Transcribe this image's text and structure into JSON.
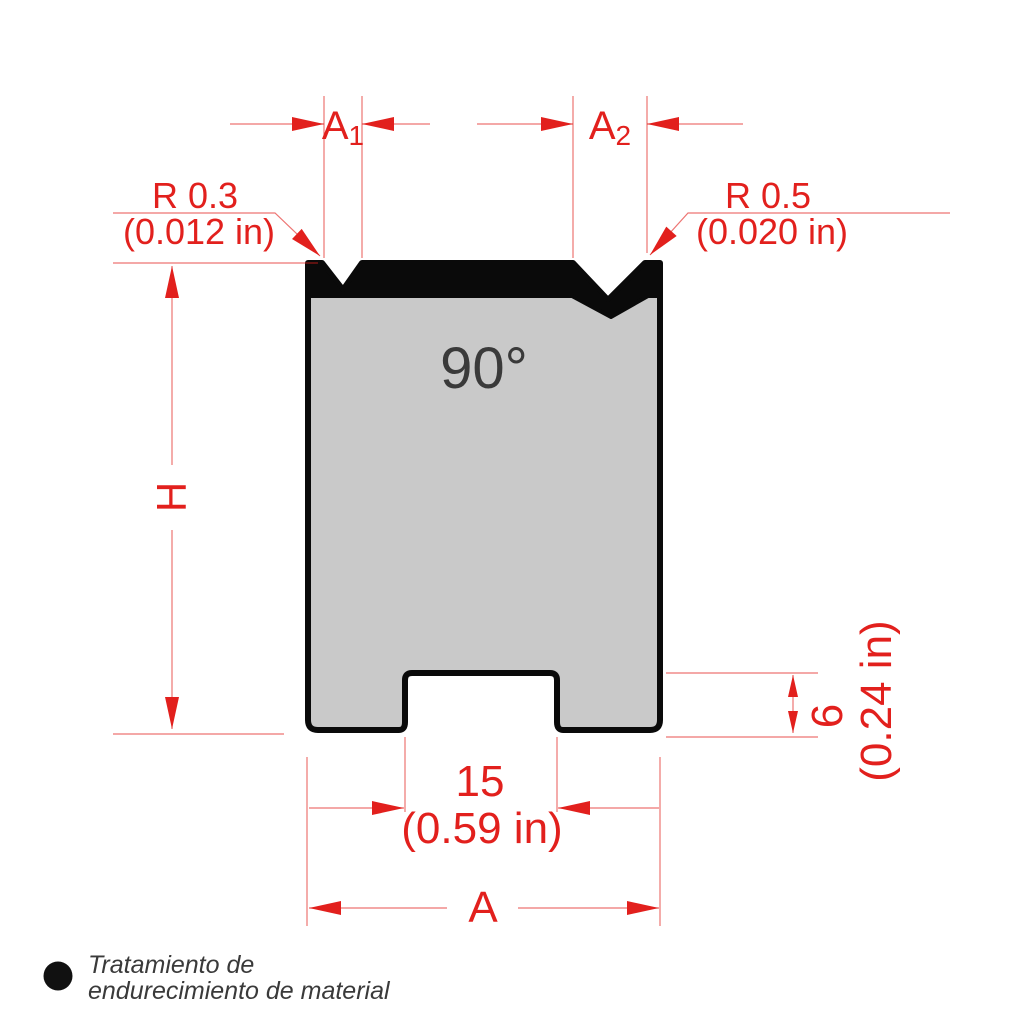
{
  "drawing": {
    "angle_label": "90°",
    "dim_a1": {
      "main": "A",
      "sub": "1"
    },
    "dim_a2": {
      "main": "A",
      "sub": "2"
    },
    "radius_left": {
      "value": "R 0.3",
      "inches": "(0.012 in)"
    },
    "radius_right": {
      "value": "R 0.5",
      "inches": "(0.020 in)"
    },
    "dim_height": "H",
    "dim_width": "A",
    "slot_width": {
      "value": "15",
      "inches": "(0.59 in)"
    },
    "slot_depth": {
      "value": "6",
      "inches": "(0.24 in)"
    },
    "legend": {
      "line1": "Tratamiento de",
      "line2": "endurecimiento de material"
    },
    "colors": {
      "dimension_red": "#e2201d",
      "body_gray": "#c9c9c9",
      "hardened_black": "#0a0a0a",
      "annotation_dark": "#3a3a3a"
    }
  }
}
